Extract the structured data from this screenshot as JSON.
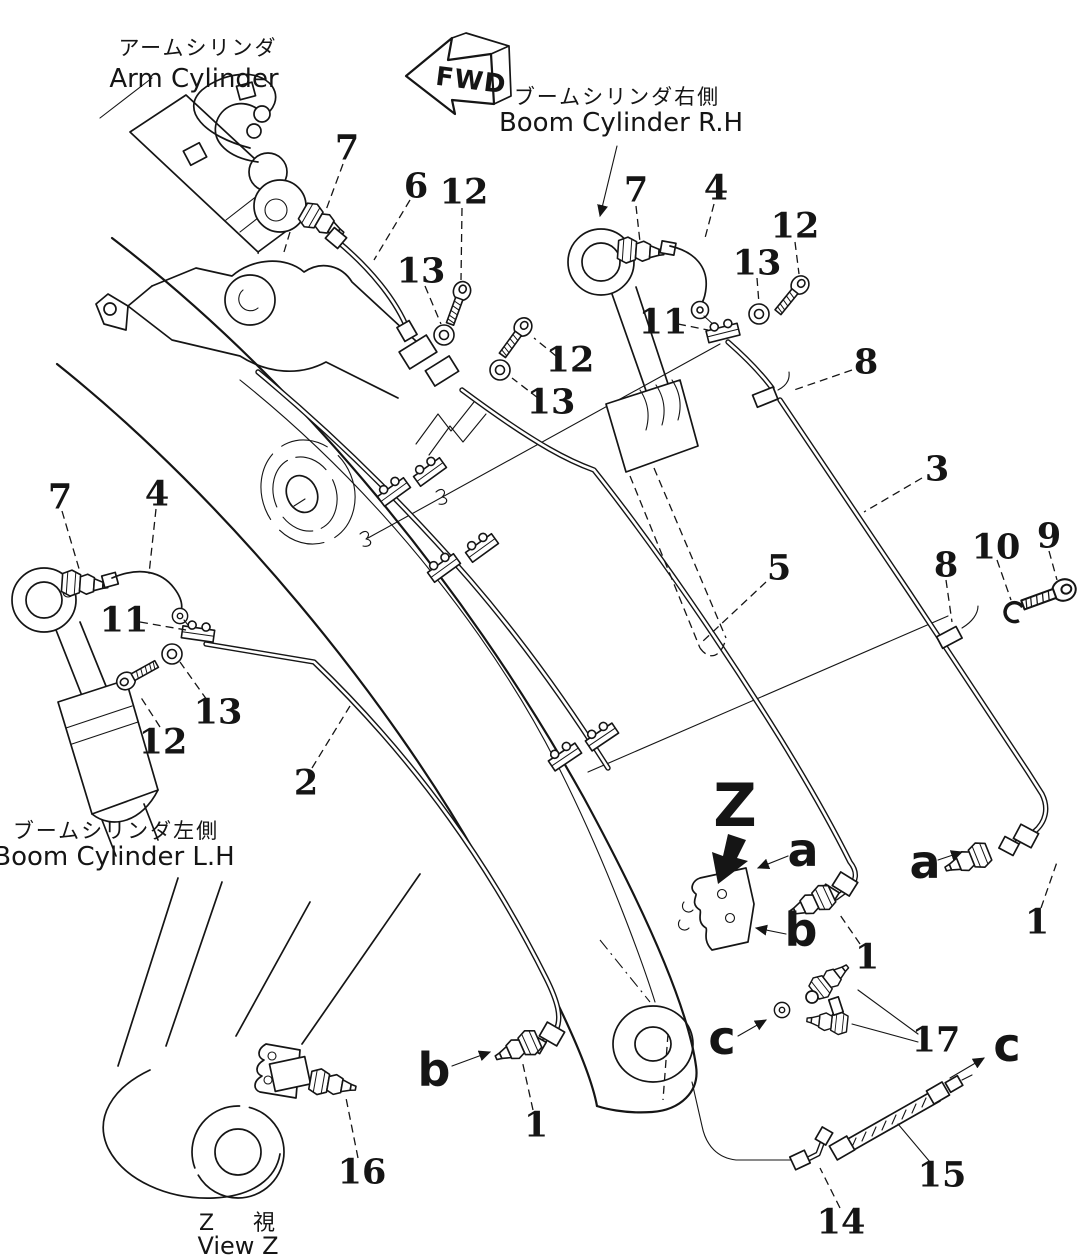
{
  "page": {
    "background": "#ffffff",
    "ink": "#151515"
  },
  "captions": {
    "arm_cylinder_jp": "アームシリンダ",
    "arm_cylinder_en": "Arm Cylinder",
    "boom_cylinder_rh_jp": "ブームシリンダ右側",
    "boom_cylinder_rh_en": "Boom Cylinder R.H",
    "boom_cylinder_lh_jp": "ブームシリンダ左側",
    "boom_cylinder_lh_en": "Boom Cylinder L.H",
    "view_z_jp": "Z 視",
    "view_z_en": "View Z",
    "fwd": "FWD"
  },
  "part_labels": [
    {
      "text": "7",
      "x": 347,
      "y": 148
    },
    {
      "text": "6",
      "x": 416,
      "y": 186
    },
    {
      "text": "12",
      "x": 464,
      "y": 192
    },
    {
      "text": "13",
      "x": 421,
      "y": 271
    },
    {
      "text": "12",
      "x": 570,
      "y": 360
    },
    {
      "text": "13",
      "x": 551,
      "y": 402
    },
    {
      "text": "7",
      "x": 636,
      "y": 190
    },
    {
      "text": "4",
      "x": 716,
      "y": 188
    },
    {
      "text": "12",
      "x": 795,
      "y": 226
    },
    {
      "text": "13",
      "x": 757,
      "y": 263
    },
    {
      "text": "11",
      "x": 663,
      "y": 322
    },
    {
      "text": "8",
      "x": 866,
      "y": 362
    },
    {
      "text": "3",
      "x": 937,
      "y": 469
    },
    {
      "text": "5",
      "x": 779,
      "y": 568
    },
    {
      "text": "8",
      "x": 946,
      "y": 565
    },
    {
      "text": "10",
      "x": 996,
      "y": 547
    },
    {
      "text": "9",
      "x": 1049,
      "y": 536
    },
    {
      "text": "7",
      "x": 60,
      "y": 497
    },
    {
      "text": "4",
      "x": 157,
      "y": 494
    },
    {
      "text": "11",
      "x": 124,
      "y": 620
    },
    {
      "text": "13",
      "x": 218,
      "y": 712
    },
    {
      "text": "12",
      "x": 163,
      "y": 742
    },
    {
      "text": "2",
      "x": 306,
      "y": 783
    },
    {
      "text": "1",
      "x": 1037,
      "y": 922
    },
    {
      "text": "1",
      "x": 867,
      "y": 957
    },
    {
      "text": "17",
      "x": 936,
      "y": 1040
    },
    {
      "text": "15",
      "x": 942,
      "y": 1175
    },
    {
      "text": "14",
      "x": 841,
      "y": 1222
    },
    {
      "text": "1",
      "x": 536,
      "y": 1125
    },
    {
      "text": "16",
      "x": 362,
      "y": 1172
    }
  ],
  "view_markers": [
    {
      "text": "Z",
      "x": 735,
      "y": 806,
      "size": 60
    },
    {
      "text": "a",
      "x": 803,
      "y": 850,
      "size": 46
    },
    {
      "text": "a",
      "x": 925,
      "y": 862,
      "size": 46
    },
    {
      "text": "b",
      "x": 801,
      "y": 930,
      "size": 46
    },
    {
      "text": "b",
      "x": 434,
      "y": 1070,
      "size": 46
    },
    {
      "text": "c",
      "x": 722,
      "y": 1038,
      "size": 46
    },
    {
      "text": "c",
      "x": 1007,
      "y": 1045,
      "size": 46
    }
  ]
}
